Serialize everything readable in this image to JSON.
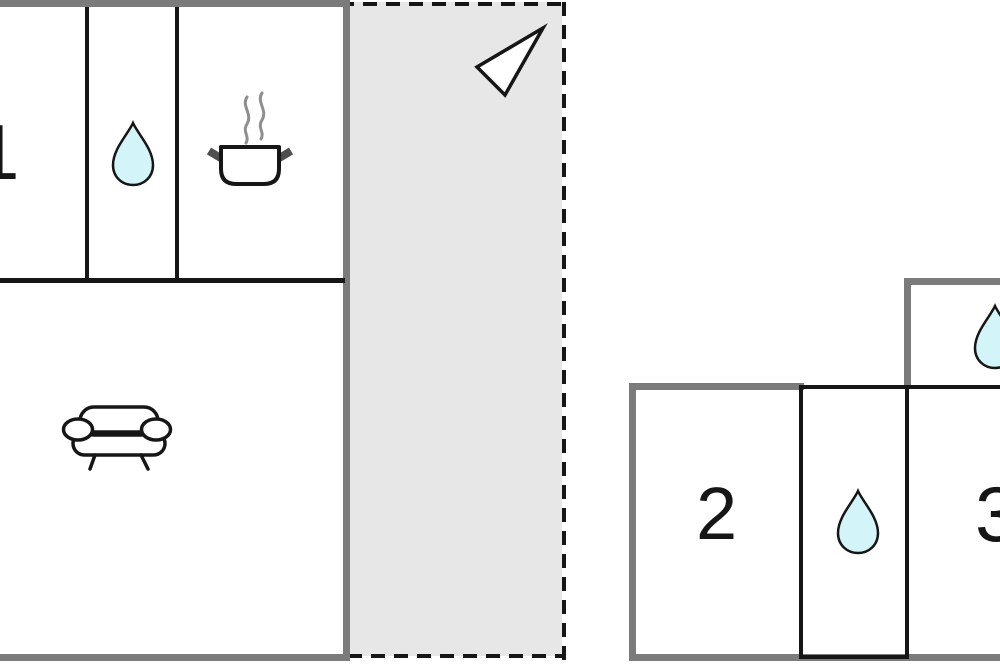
{
  "title": "apartment-floor-plan",
  "rooms": {
    "room1": {
      "label": "1"
    },
    "room2": {
      "label": "2"
    },
    "room3": {
      "label": "3"
    }
  },
  "icons": {
    "water_drop": "water-drop",
    "cooking_pot": "cooking-pot",
    "sofa": "sofa",
    "north_arrow": "north-arrow"
  },
  "colors": {
    "wall_outer": "#7b7b7b",
    "wall_inner": "#161616",
    "terrace_fill": "#e7e7e7",
    "drop_fill": "#d3f4f8",
    "icon_stroke": "#161616",
    "icon_fill": "#ffffff",
    "steam": "#8f8f8f",
    "handle": "#4f4f4f"
  }
}
